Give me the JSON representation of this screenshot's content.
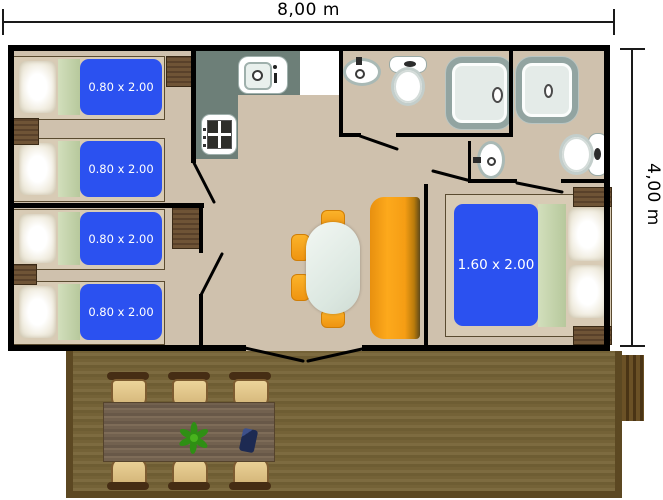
{
  "plan": {
    "width_label": "8,00 m",
    "height_label": "4,00 m",
    "single_bed_labels": [
      "0.80 x 2.00",
      "0.80 x 2.00",
      "0.80 x 2.00",
      "0.80 x 2.00"
    ],
    "double_bed_label": "1.60 x 2.00",
    "colors": {
      "wall": "#000000",
      "floor": "#cfc1ad",
      "bed_mattress_blue": "#2b51f0",
      "bed_blanket_green": "#c6d5ac",
      "kitchen_counter": "#6d7f78",
      "sofa_orange": "#f9a01b",
      "stool_orange": "#f9a41c",
      "wood_furniture": "#6f5436",
      "deck_floor": "#79673d",
      "deck_table": "#70604f",
      "deck_chair": "#e2c98f",
      "fixture_accent": "#a9b9b5",
      "plant_green": "#2f8f14",
      "object_navy": "#1d2a52"
    }
  }
}
